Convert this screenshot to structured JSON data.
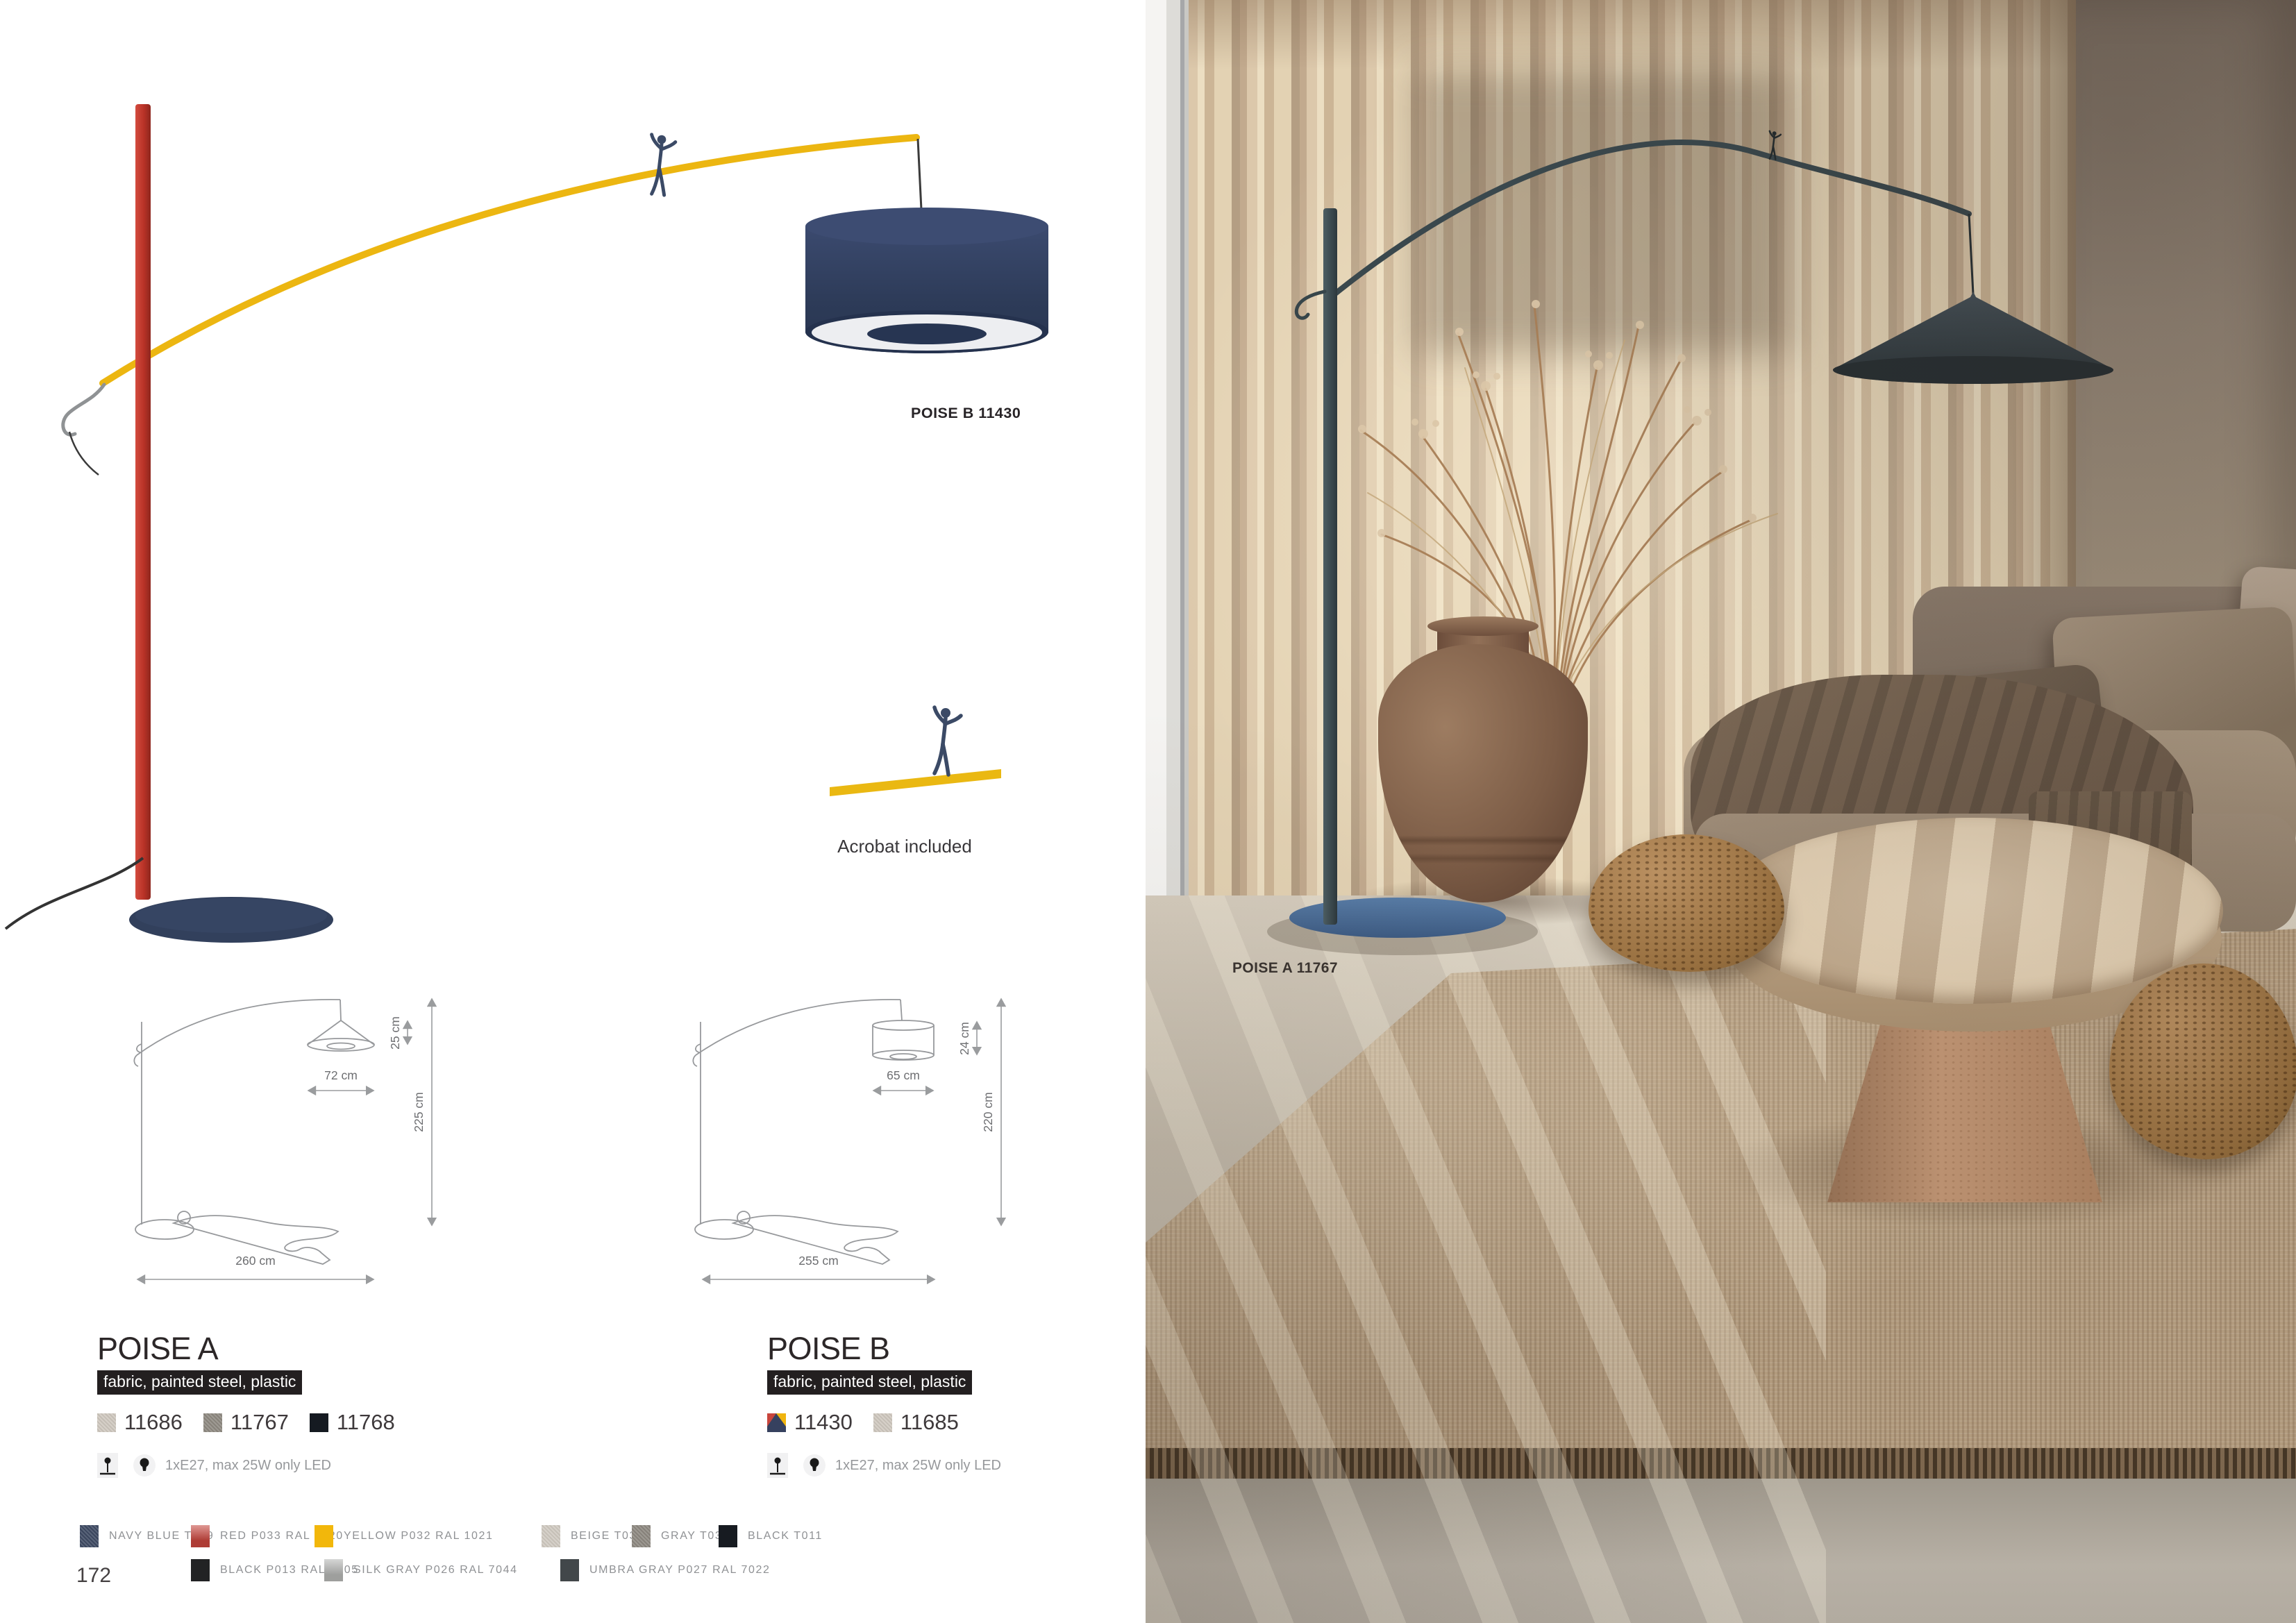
{
  "catalog": {
    "page_number": "172",
    "hero_label": "POISE B 11430",
    "acrobat_note": "Acrobat included",
    "photo_label": "POISE A 11767",
    "products": [
      {
        "name": "POISE A",
        "materials": "fabric, painted steel, plastic",
        "spec": "1xE27, max 25W only LED",
        "variants": [
          {
            "code": "11686",
            "color": "#cfc8bf"
          },
          {
            "code": "11767",
            "color": "#8e8981"
          },
          {
            "code": "11768",
            "color": "#151a21"
          }
        ],
        "dims": {
          "shade_h": "25 cm",
          "shade_w": "72 cm",
          "height": "225 cm",
          "width": "260 cm"
        }
      },
      {
        "name": "POISE B",
        "materials": "fabric, painted steel, plastic",
        "spec": "1xE27, max 25W only LED",
        "variants": [
          {
            "code": "11430",
            "color": "#36415f",
            "multi": {
              "red": "#c8453c",
              "yellow": "#f0b40e",
              "navy": "#36415f"
            }
          },
          {
            "code": "11685",
            "color": "#cfc8bf"
          }
        ],
        "dims": {
          "shade_h": "24 cm",
          "shade_w": "65 cm",
          "height": "220 cm",
          "width": "255 cm"
        }
      }
    ],
    "legend": [
      {
        "name": "NAVY BLUE T039",
        "color": "#3e4a63"
      },
      {
        "name": "RED P033 RAL 3020",
        "color": "#c6443c"
      },
      {
        "name": "YELLOW P032 RAL 1021",
        "color": "#f2b70b"
      },
      {
        "name": "BEIGE T034",
        "color": "#d0cac1"
      },
      {
        "name": "GRAY T035",
        "color": "#8d8880"
      },
      {
        "name": "BLACK T011",
        "color": "#171b21"
      },
      {
        "name": "BLACK P013 RAL 9005",
        "color": "#222324"
      },
      {
        "name": "SILK GRAY P026 RAL 7044",
        "color": "#b4b5b3"
      },
      {
        "name": "UMBRA GRAY P027 RAL 7022",
        "color": "#42474a"
      }
    ],
    "artwork_colors": {
      "pole_red": "#c23b31",
      "arc_yellow": "#ecb611",
      "shade_navy": "#2e3d59",
      "base_navy": "#32405c",
      "photo_lamp_steel": "#3d4d52",
      "photo_base_blue": "#4a6b92"
    }
  }
}
